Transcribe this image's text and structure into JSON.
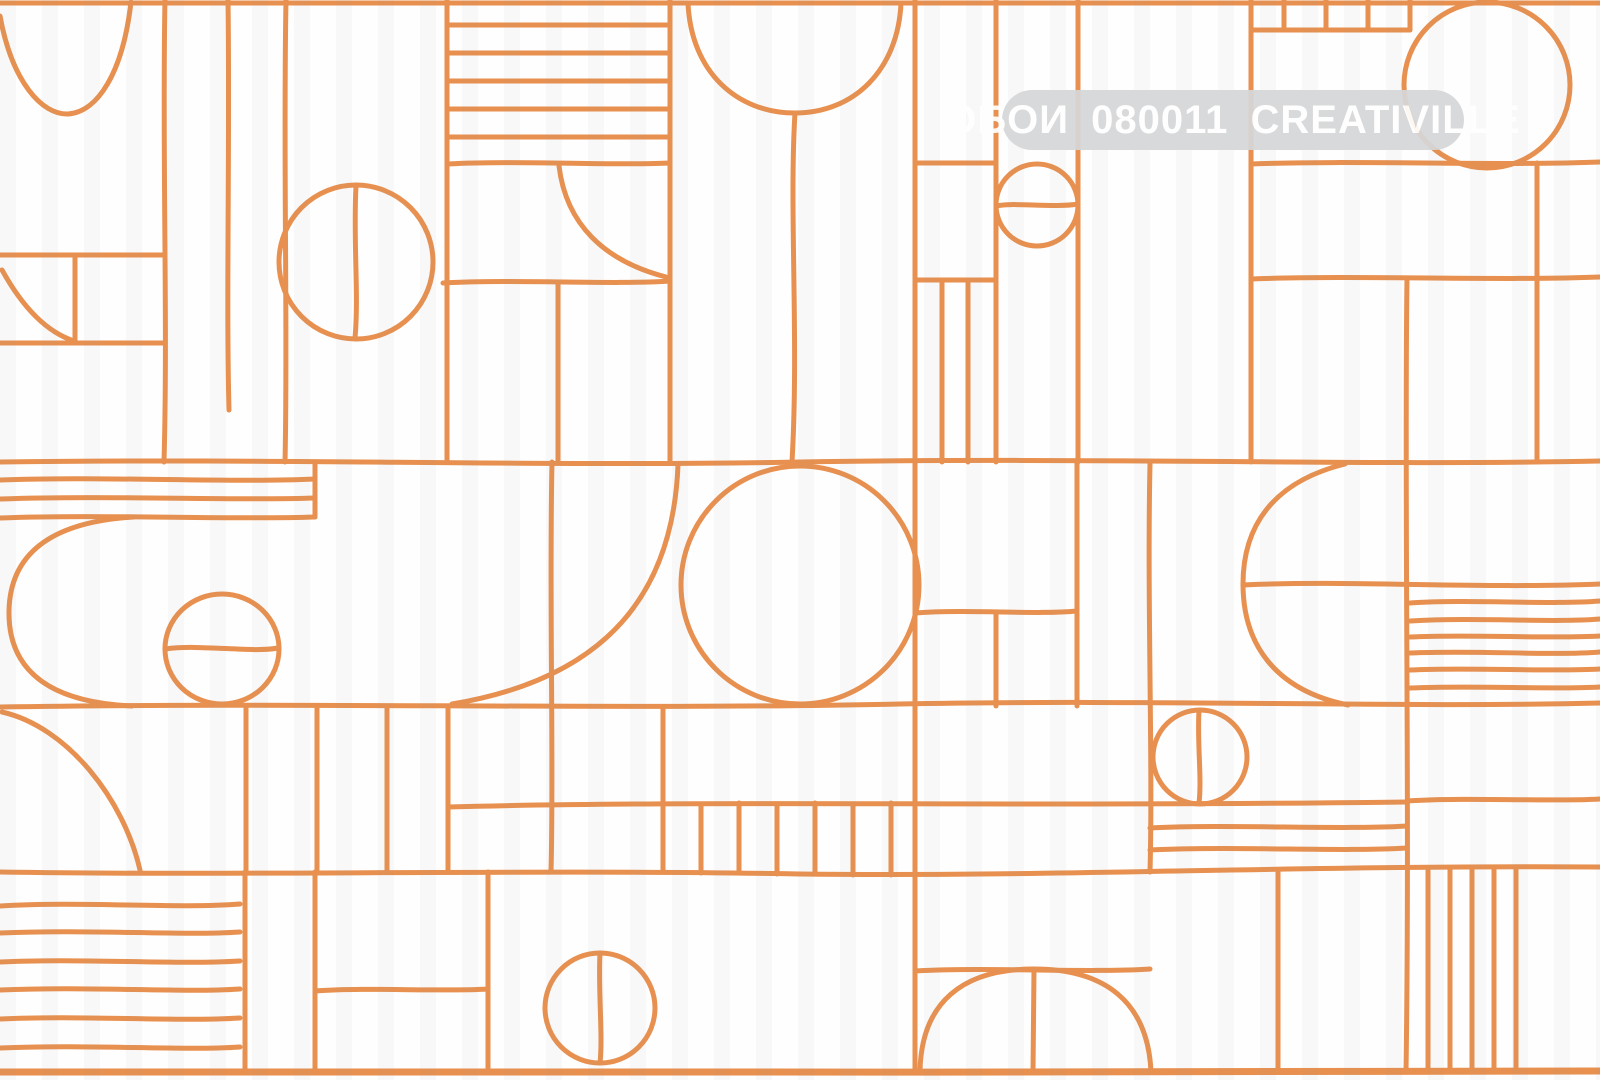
{
  "watermark": {
    "text": "ОБОИ 080011 CREATIVILLE",
    "bg_color": "#d6d7d9",
    "bg_opacity": 0.93,
    "text_color": "#ffffff",
    "font_size_px": 40,
    "x": 1002,
    "y": 90,
    "width": 462,
    "height": 60
  },
  "canvas": {
    "width": 1600,
    "height": 1080,
    "background": "#fefefe",
    "stroke": "#e8904f",
    "stroke_width": 5
  },
  "shapes": [
    {
      "t": "p",
      "n": "tile-top-border",
      "d": "M 0 3 L 1600 3"
    },
    {
      "t": "p",
      "n": "tile-bottom-border",
      "w": 7,
      "d": "M 0 1072 C 400 1070, 1100 1074, 1600 1071"
    },
    {
      "t": "p",
      "n": "row-line-1",
      "d": "M 0 462 C 300 458, 520 467, 800 462 C 1100 457, 1360 466, 1600 461"
    },
    {
      "t": "p",
      "n": "row-line-2",
      "d": "M 0 707 C 300 702, 620 710, 900 704 C 1150 699, 1400 708, 1600 703"
    },
    {
      "t": "p",
      "n": "row-line-3",
      "d": "M 0 872 C 250 876, 520 869, 800 874 C 1060 877, 1300 865, 1600 867"
    },
    {
      "t": "p",
      "n": "top-left-bowl-arc",
      "d": "M 0 16 C 12 82, 42 115, 68 114 C 98 112, 123 72, 131 2"
    },
    {
      "t": "p",
      "n": "vertical-line",
      "d": "M 165 0 C 162 150, 168 320, 164 462"
    },
    {
      "t": "p",
      "n": "vertical-line",
      "d": "M 228 0 C 230 140, 226 300, 229 410"
    },
    {
      "t": "p",
      "n": "vertical-line",
      "d": "M 286 0 C 283 160, 288 330, 285 462"
    },
    {
      "t": "l",
      "n": "vertical-line",
      "x1": 447,
      "y1": 0,
      "x2": 447,
      "y2": 462
    },
    {
      "t": "l",
      "n": "vertical-line",
      "x1": 670,
      "y1": 0,
      "x2": 670,
      "y2": 462
    },
    {
      "t": "l",
      "n": "small-box-top",
      "x1": 0,
      "y1": 255,
      "x2": 165,
      "y2": 255
    },
    {
      "t": "l",
      "n": "small-box-bottom",
      "x1": 0,
      "y1": 343,
      "x2": 165,
      "y2": 343
    },
    {
      "t": "l",
      "n": "small-box-divider",
      "x1": 75,
      "y1": 255,
      "x2": 75,
      "y2": 343
    },
    {
      "t": "p",
      "n": "small-box-arc",
      "d": "M 2 270 Q 34 328 74 341"
    },
    {
      "t": "c",
      "n": "grid-circle",
      "cx": 356,
      "cy": 262,
      "r": 77
    },
    {
      "t": "p",
      "n": "circle-diameter-line",
      "d": "M 356 186 C 353 240, 359 295, 355 338"
    },
    {
      "t": "l",
      "n": "stripe-line",
      "x1": 447,
      "y1": 25,
      "x2": 670,
      "y2": 25
    },
    {
      "t": "l",
      "n": "stripe-line",
      "x1": 447,
      "y1": 53,
      "x2": 670,
      "y2": 53
    },
    {
      "t": "l",
      "n": "stripe-line",
      "x1": 447,
      "y1": 81,
      "x2": 670,
      "y2": 81
    },
    {
      "t": "l",
      "n": "stripe-line",
      "x1": 447,
      "y1": 109,
      "x2": 670,
      "y2": 109
    },
    {
      "t": "l",
      "n": "stripe-line",
      "x1": 447,
      "y1": 137,
      "x2": 670,
      "y2": 137
    },
    {
      "t": "p",
      "n": "stripe-line",
      "d": "M 447 164 C 520 160, 610 166, 670 163"
    },
    {
      "t": "p",
      "n": "quarter-arc",
      "d": "M 559 166 C 566 224, 604 261, 666 277"
    },
    {
      "t": "p",
      "n": "cell-divider",
      "d": "M 443 283 C 520 279, 610 285, 670 281"
    },
    {
      "t": "l",
      "n": "vertical-line",
      "x1": 558,
      "y1": 282,
      "x2": 558,
      "y2": 462
    },
    {
      "t": "p",
      "n": "balloon-circle",
      "d": "M 688 3 C 691 72, 737 113, 795 113 C 854 113, 898 70, 901 3"
    },
    {
      "t": "p",
      "n": "balloon-trunk",
      "d": "M 795 113 C 789 210, 799 340, 792 462"
    },
    {
      "t": "l",
      "n": "vertical-line",
      "x1": 915,
      "y1": 0,
      "x2": 915,
      "y2": 1072
    },
    {
      "t": "l",
      "n": "vertical-line",
      "x1": 996,
      "y1": 0,
      "x2": 996,
      "y2": 462
    },
    {
      "t": "l",
      "n": "cell-divider",
      "x1": 915,
      "y1": 163,
      "x2": 996,
      "y2": 163
    },
    {
      "t": "c",
      "n": "small-circle",
      "cx": 1037,
      "cy": 205,
      "r": 41
    },
    {
      "t": "p",
      "n": "circle-diameter-line",
      "d": "M 997 206 C 1010 202, 1055 208, 1078 204"
    },
    {
      "t": "l",
      "n": "vertical-line",
      "x1": 1078,
      "y1": 0,
      "x2": 1078,
      "y2": 462
    },
    {
      "t": "l",
      "n": "cell-divider",
      "x1": 915,
      "y1": 280,
      "x2": 996,
      "y2": 280
    },
    {
      "t": "l",
      "n": "stripe-line",
      "x1": 942,
      "y1": 280,
      "x2": 942,
      "y2": 462
    },
    {
      "t": "l",
      "n": "stripe-line",
      "x1": 968,
      "y1": 280,
      "x2": 968,
      "y2": 462
    },
    {
      "t": "l",
      "n": "vertical-line",
      "x1": 1251,
      "y1": 0,
      "x2": 1251,
      "y2": 462
    },
    {
      "t": "l",
      "n": "comb-tick",
      "x1": 1284,
      "y1": 0,
      "x2": 1284,
      "y2": 30
    },
    {
      "t": "l",
      "n": "comb-tick",
      "x1": 1326,
      "y1": 0,
      "x2": 1326,
      "y2": 30
    },
    {
      "t": "l",
      "n": "comb-tick",
      "x1": 1368,
      "y1": 0,
      "x2": 1368,
      "y2": 30
    },
    {
      "t": "l",
      "n": "comb-tick",
      "x1": 1410,
      "y1": 0,
      "x2": 1410,
      "y2": 30
    },
    {
      "t": "l",
      "n": "comb-base",
      "x1": 1251,
      "y1": 30,
      "x2": 1410,
      "y2": 30
    },
    {
      "t": "c",
      "n": "large-circle",
      "cx": 1487,
      "cy": 85,
      "r": 83
    },
    {
      "t": "p",
      "n": "cell-divider",
      "d": "M 1251 164 C 1350 160, 1500 166, 1600 162"
    },
    {
      "t": "p",
      "n": "cell-divider",
      "d": "M 1251 279 C 1360 275, 1500 281, 1600 277"
    },
    {
      "t": "p",
      "n": "vertical-line",
      "d": "M 1407 278 C 1404 500, 1410 800, 1406 1072"
    },
    {
      "t": "l",
      "n": "vertical-line",
      "x1": 1537,
      "y1": 163,
      "x2": 1537,
      "y2": 462
    },
    {
      "t": "p",
      "n": "stripe-line",
      "d": "M 0 480 C 100 476, 230 483, 315 479"
    },
    {
      "t": "p",
      "n": "stripe-line",
      "d": "M 0 499 C 110 495, 230 501, 315 498"
    },
    {
      "t": "p",
      "n": "stripe-line",
      "d": "M 0 518 C 100 514, 230 520, 315 517"
    },
    {
      "t": "l",
      "n": "vertical-line",
      "x1": 315,
      "y1": 462,
      "x2": 315,
      "y2": 517
    },
    {
      "t": "p",
      "n": "capsule-cap-arc",
      "d": "M 134 517 C 48 522, 10 556, 9 611 C 8 668, 46 702, 132 706"
    },
    {
      "t": "e",
      "n": "egg-circle",
      "cx": 222,
      "cy": 649,
      "rx": 57,
      "ry": 55
    },
    {
      "t": "p",
      "n": "circle-diameter-line",
      "d": "M 165 649 C 200 644, 252 653, 278 648"
    },
    {
      "t": "p",
      "n": "vertical-line",
      "d": "M 552 462 C 549 600, 554 760, 551 872"
    },
    {
      "t": "p",
      "n": "sweep-arc",
      "d": "M 678 465 C 673 592, 608 678, 452 704"
    },
    {
      "t": "c",
      "n": "big-ball-circle",
      "cx": 800,
      "cy": 585,
      "r": 119
    },
    {
      "t": "p",
      "n": "cell-divider",
      "d": "M 915 613 C 970 609, 1035 615, 1077 611"
    },
    {
      "t": "l",
      "n": "vertical-line",
      "x1": 996,
      "y1": 612,
      "x2": 996,
      "y2": 706
    },
    {
      "t": "l",
      "n": "vertical-line",
      "x1": 1077,
      "y1": 462,
      "x2": 1077,
      "y2": 706
    },
    {
      "t": "p",
      "n": "vertical-line",
      "d": "M 1150 464 C 1147 600, 1153 760, 1150 872"
    },
    {
      "t": "p",
      "n": "half-circle-arc",
      "d": "M 1345 464 C 1272 482, 1243 527, 1243 584 C 1243 643, 1274 690, 1348 705"
    },
    {
      "t": "p",
      "n": "midline",
      "d": "M 1243 585 C 1350 580, 1480 589, 1600 584"
    },
    {
      "t": "p",
      "n": "stripe-line",
      "d": "M 1410 603 C 1470 599, 1550 605, 1600 601"
    },
    {
      "t": "p",
      "n": "stripe-line",
      "d": "M 1410 621 C 1480 617, 1550 623, 1600 619"
    },
    {
      "t": "p",
      "n": "stripe-line",
      "d": "M 1410 637 C 1470 634, 1550 639, 1600 636"
    },
    {
      "t": "p",
      "n": "stripe-line",
      "d": "M 1410 653 C 1480 650, 1550 656, 1600 652"
    },
    {
      "t": "p",
      "n": "stripe-line",
      "d": "M 1410 670 C 1470 667, 1550 672, 1600 669"
    },
    {
      "t": "p",
      "n": "stripe-line",
      "d": "M 1410 688 C 1480 685, 1550 690, 1600 687"
    },
    {
      "t": "p",
      "n": "corner-sweep-arc",
      "d": "M 2 712 C 68 727, 124 800, 140 870"
    },
    {
      "t": "l",
      "n": "vertical-line",
      "x1": 246,
      "y1": 707,
      "x2": 246,
      "y2": 872
    },
    {
      "t": "l",
      "n": "vertical-line",
      "x1": 317,
      "y1": 707,
      "x2": 317,
      "y2": 872
    },
    {
      "t": "l",
      "n": "vertical-line",
      "x1": 387,
      "y1": 707,
      "x2": 387,
      "y2": 872
    },
    {
      "t": "l",
      "n": "vertical-line",
      "x1": 448,
      "y1": 707,
      "x2": 448,
      "y2": 872
    },
    {
      "t": "p",
      "n": "long-divider",
      "d": "M 448 807 C 700 800, 1000 807, 1407 802"
    },
    {
      "t": "l",
      "n": "vertical-line",
      "x1": 663,
      "y1": 707,
      "x2": 663,
      "y2": 872
    },
    {
      "t": "l",
      "n": "comb-tick",
      "x1": 701,
      "y1": 804,
      "x2": 701,
      "y2": 873
    },
    {
      "t": "l",
      "n": "comb-tick",
      "x1": 739,
      "y1": 803,
      "x2": 739,
      "y2": 873
    },
    {
      "t": "l",
      "n": "comb-tick",
      "x1": 777,
      "y1": 804,
      "x2": 777,
      "y2": 874
    },
    {
      "t": "l",
      "n": "comb-tick",
      "x1": 815,
      "y1": 803,
      "x2": 815,
      "y2": 874
    },
    {
      "t": "l",
      "n": "comb-tick",
      "x1": 853,
      "y1": 804,
      "x2": 853,
      "y2": 875
    },
    {
      "t": "l",
      "n": "comb-tick",
      "x1": 891,
      "y1": 803,
      "x2": 891,
      "y2": 875
    },
    {
      "t": "c",
      "n": "small-circle",
      "cx": 1200,
      "cy": 757,
      "r": 47
    },
    {
      "t": "p",
      "n": "circle-diameter-line",
      "d": "M 1199 711 C 1197 742, 1202 778, 1199 803"
    },
    {
      "t": "p",
      "n": "stripe-line",
      "d": "M 1150 828 C 1230 824, 1340 830, 1407 826"
    },
    {
      "t": "p",
      "n": "stripe-line",
      "d": "M 1150 850 C 1240 846, 1340 852, 1407 848"
    },
    {
      "t": "p",
      "n": "cell-divider",
      "d": "M 1407 801 C 1470 797, 1550 802, 1600 799"
    },
    {
      "t": "p",
      "n": "stripe-line",
      "d": "M 0 906 C 80 901, 175 909, 240 904"
    },
    {
      "t": "p",
      "n": "stripe-line",
      "d": "M 0 933 C 90 929, 180 936, 240 932"
    },
    {
      "t": "p",
      "n": "stripe-line",
      "d": "M 0 962 C 80 958, 175 965, 240 961"
    },
    {
      "t": "p",
      "n": "stripe-line",
      "d": "M 0 990 C 90 986, 180 993, 240 989"
    },
    {
      "t": "p",
      "n": "stripe-line",
      "d": "M 0 1019 C 80 1015, 175 1022, 240 1018"
    },
    {
      "t": "p",
      "n": "stripe-line",
      "d": "M 0 1048 C 90 1044, 180 1051, 240 1047"
    },
    {
      "t": "l",
      "n": "vertical-line",
      "x1": 245,
      "y1": 872,
      "x2": 245,
      "y2": 1072
    },
    {
      "t": "l",
      "n": "vertical-line",
      "x1": 315,
      "y1": 872,
      "x2": 315,
      "y2": 1072
    },
    {
      "t": "p",
      "n": "cell-divider",
      "d": "M 315 991 C 370 987, 440 992, 488 989"
    },
    {
      "t": "l",
      "n": "vertical-line",
      "x1": 488,
      "y1": 872,
      "x2": 488,
      "y2": 1072
    },
    {
      "t": "c",
      "n": "small-circle",
      "cx": 600,
      "cy": 1008,
      "r": 55
    },
    {
      "t": "p",
      "n": "circle-diameter-line",
      "d": "M 600 953 C 598 990, 603 1035, 600 1063"
    },
    {
      "t": "p",
      "n": "dome-top-line",
      "d": "M 915 971 C 990 967, 1085 973, 1150 969"
    },
    {
      "t": "p",
      "n": "dome-arc",
      "d": "M 920 1072 C 921 1002, 963 969, 1034 969 C 1105 969, 1148 1002, 1151 1072"
    },
    {
      "t": "p",
      "n": "dome-center-line",
      "d": "M 1034 969 L 1033 1072"
    },
    {
      "t": "l",
      "n": "vertical-line",
      "x1": 1278,
      "y1": 872,
      "x2": 1278,
      "y2": 1072
    },
    {
      "t": "l",
      "n": "comb-tick",
      "x1": 1428,
      "y1": 869,
      "x2": 1428,
      "y2": 1072
    },
    {
      "t": "l",
      "n": "comb-tick",
      "x1": 1450,
      "y1": 869,
      "x2": 1450,
      "y2": 1072
    },
    {
      "t": "l",
      "n": "comb-tick",
      "x1": 1472,
      "y1": 868,
      "x2": 1472,
      "y2": 1072
    },
    {
      "t": "l",
      "n": "comb-tick",
      "x1": 1494,
      "y1": 868,
      "x2": 1494,
      "y2": 1072
    },
    {
      "t": "l",
      "n": "comb-tick",
      "x1": 1516,
      "y1": 868,
      "x2": 1516,
      "y2": 1072
    }
  ]
}
